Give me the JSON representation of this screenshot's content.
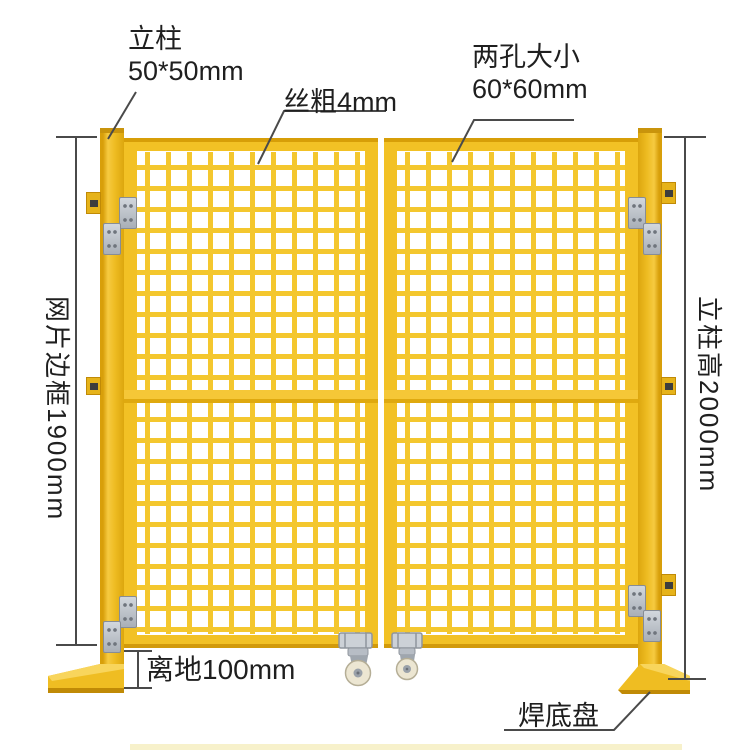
{
  "annotations": {
    "top_left": {
      "line1": "立柱",
      "line2": "50*50mm"
    },
    "top_center": {
      "text": "丝粗4mm"
    },
    "top_right": {
      "line1": "两孔大小",
      "line2": "60*60mm"
    },
    "left_vertical": {
      "text": "网片边框1900mm"
    },
    "right_vertical": {
      "text": "立柱高2000mm"
    },
    "bottom_left": {
      "text": "离地100mm"
    },
    "bottom_right": {
      "text": "焊底盘"
    }
  },
  "colors": {
    "background": "#FFFFFF",
    "fence_yellow": "#F2C125",
    "fence_yellow_dark": "#D79E08",
    "fence_yellow_deep": "#C9940C",
    "mesh_wire": "#F4C72E",
    "metal_hinge": "#C3C8CE",
    "caster_wheel": "#ECE6D2",
    "dimension_line": "#4A4A4A",
    "text": "#1F1F1F"
  },
  "icons": {
    "hinge": "hinge-plate",
    "caster": "swivel-caster-wheel",
    "base": "welded-base-plate"
  }
}
